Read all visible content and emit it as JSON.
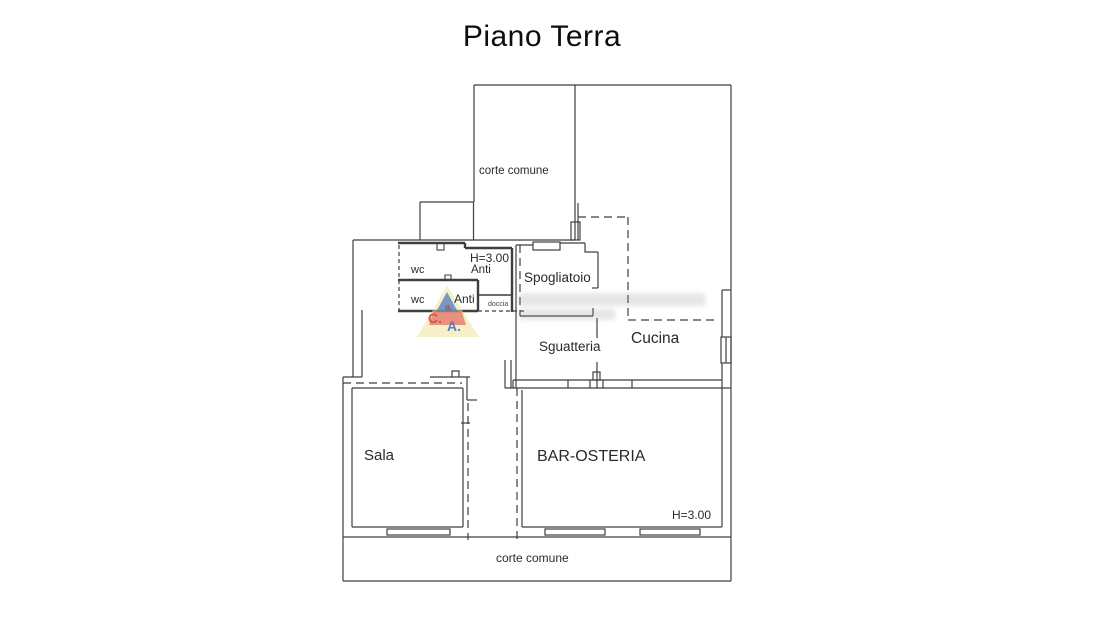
{
  "title": "Piano Terra",
  "labels": {
    "corte_comune_top": "corte comune",
    "h_upper": "H=3.00",
    "wc_upper": "wc",
    "anti_upper": "Anti",
    "wc_lower": "wc",
    "anti_lower": "Anti",
    "doccia": "doccia",
    "spogliatoio": "Spogliatoio",
    "sguatteria": "Sguatteria",
    "cucina": "Cucina",
    "sala": "Sala",
    "bar_osteria": "BAR-OSTERIA",
    "h_lower": "H=3.00",
    "corte_comune_bottom": "corte comune"
  },
  "watermark": {
    "letter_top": "a.",
    "letter_left": "C.",
    "letter_right": "A.",
    "colors": {
      "triangle_outer": "#eee39a",
      "triangle_blue": "#5a82c4",
      "triangle_red": "#e2685c",
      "letter_left_color": "#d14b3c",
      "letter_right_color": "#4a74b8"
    }
  },
  "style": {
    "line_color": "#3f3f3f",
    "background": "#ffffff"
  }
}
